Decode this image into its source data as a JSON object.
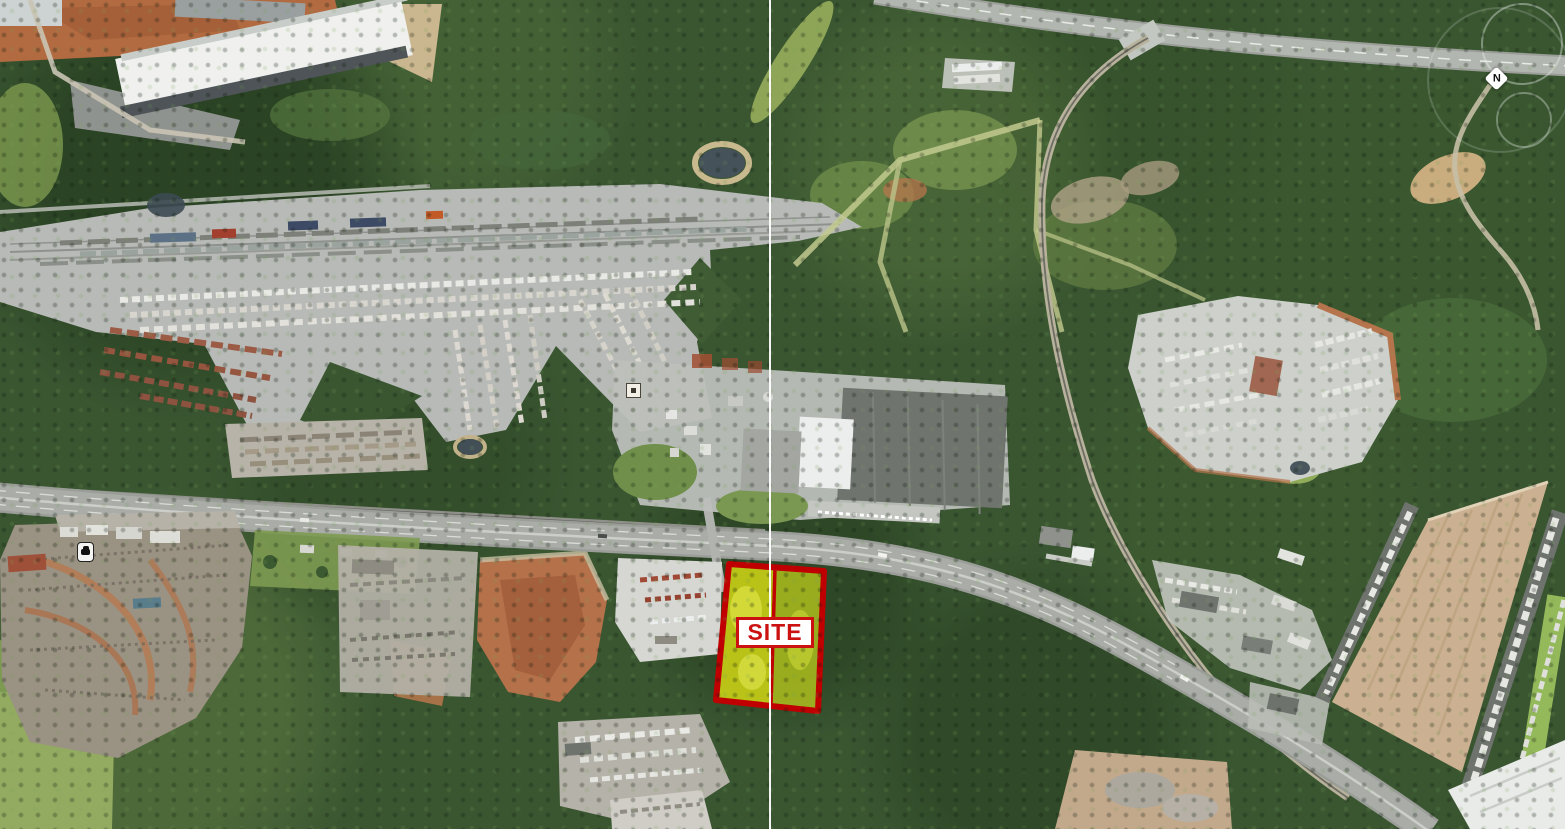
{
  "map": {
    "description": "aerial-site-map",
    "site_label": "SITE",
    "compass_label": "N",
    "colors": {
      "site_fill_left": "#e0e412",
      "site_fill_right": "#c4d31c",
      "site_border": "#c00000",
      "site_label_text": "#cc1111",
      "site_label_bg": "#ffffff",
      "seam_line": "#ffffff"
    },
    "icons": {
      "north_marker": "white diamond with N",
      "car_marker": "black car glyph on white badge",
      "square_marker": "white square with dark center"
    }
  }
}
